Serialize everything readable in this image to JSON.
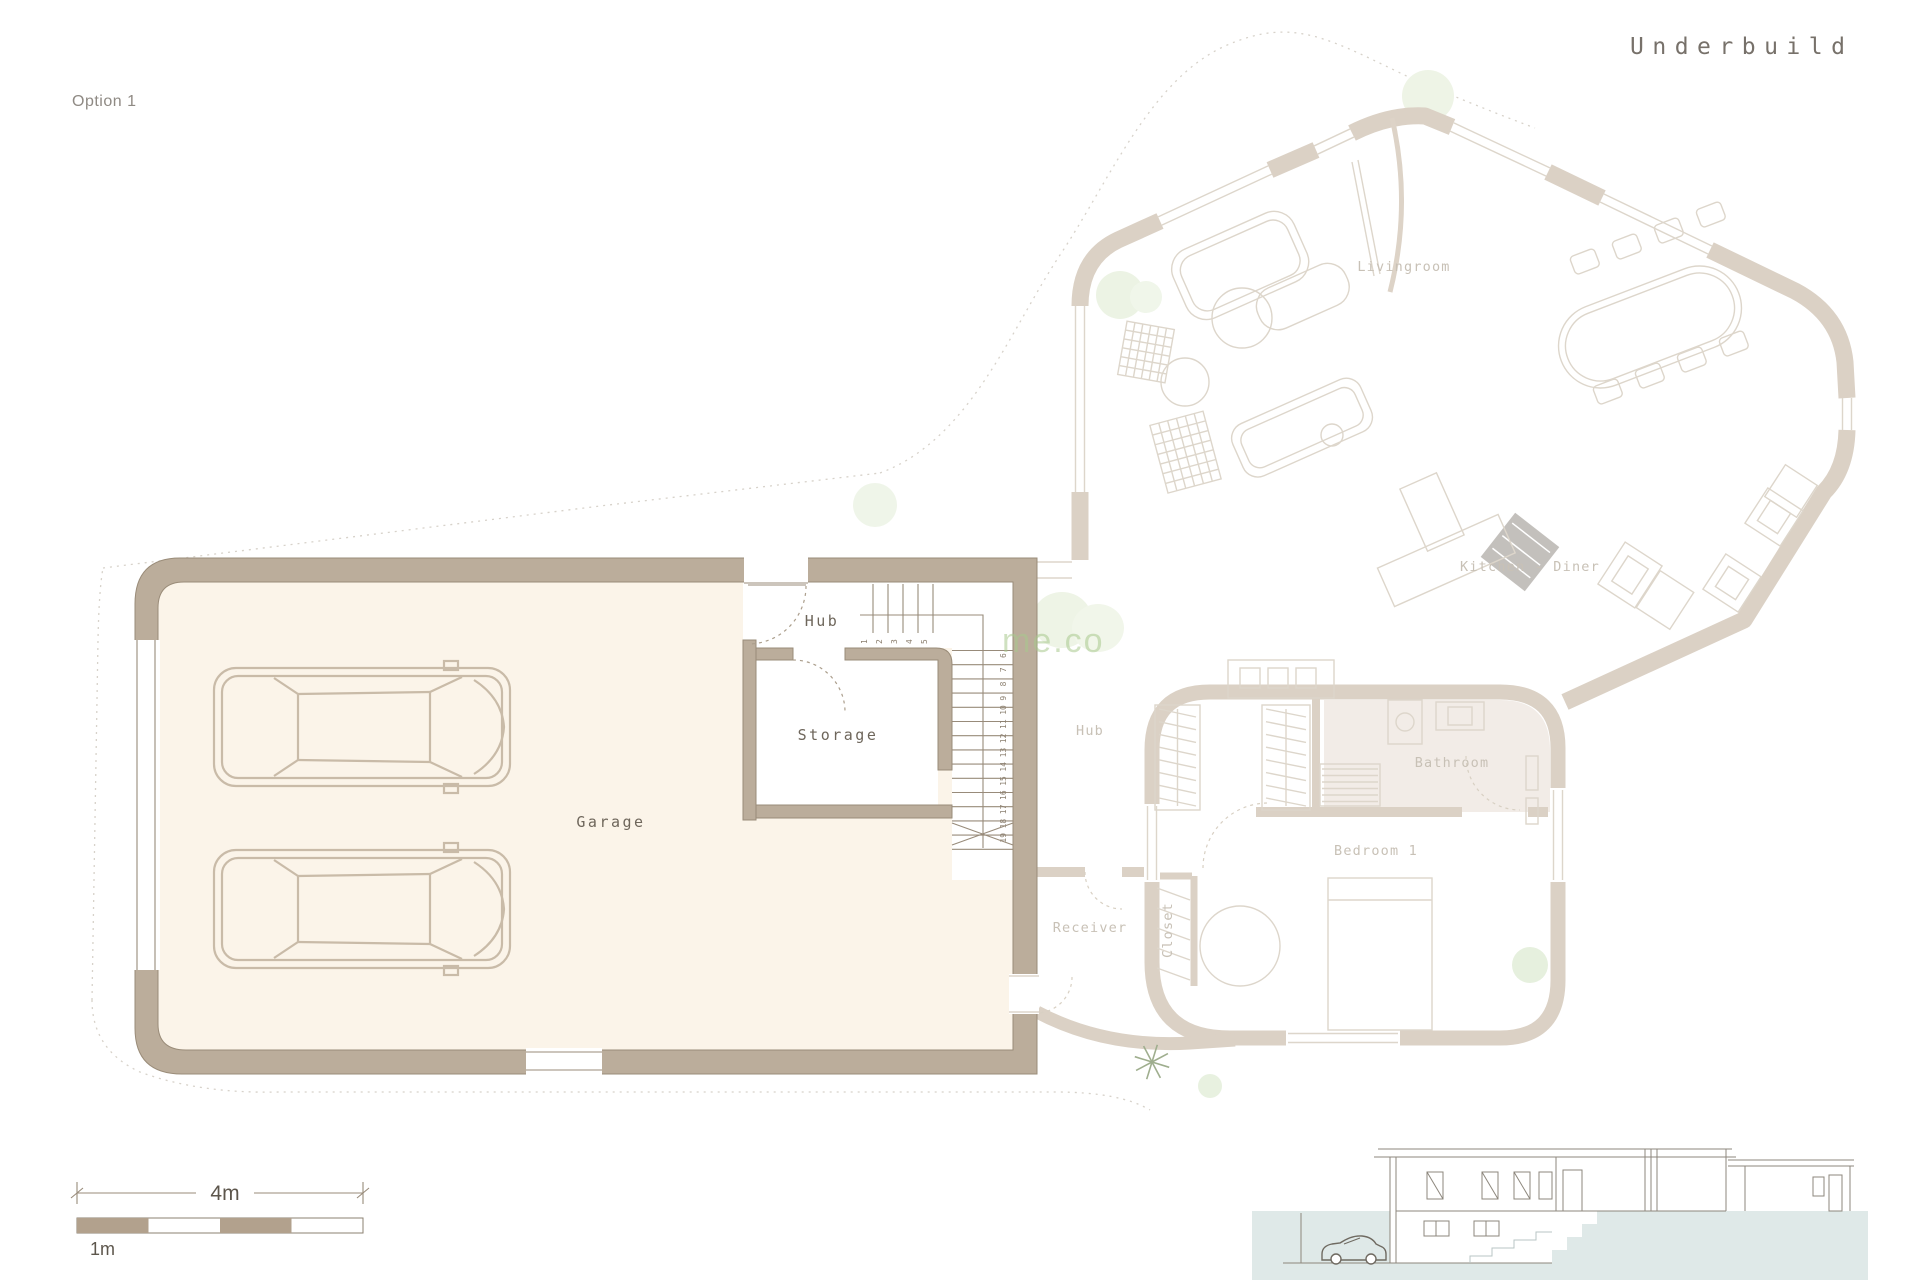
{
  "title": "Underbuild",
  "option_label": "Option 1",
  "watermark_text": "me.co",
  "rooms": {
    "garage": "Garage",
    "hub": "Hub",
    "storage": "Storage",
    "upper_hub": "Hub",
    "livingroom": "Livingroom",
    "kitchen_diner": "Kitchen - Diner",
    "bathroom": "Bathroom",
    "bedroom": "Bedroom 1",
    "receiver": "Receiver",
    "closet": "Closet"
  },
  "stairs": {
    "upper_steps": [
      "1",
      "2",
      "3",
      "4",
      "5"
    ],
    "lower_steps": [
      "6",
      "7",
      "8",
      "9",
      "10",
      "11",
      "12",
      "13",
      "14",
      "15",
      "16",
      "17",
      "18",
      "19"
    ]
  },
  "scale_bar": {
    "total": "4m",
    "unit": "1m"
  },
  "colors": {
    "crisp_wall": "#bbad9b",
    "garage_floor": "#fbf4e9",
    "faded_wall": "#dbd1c5",
    "bathroom_fill": "#f2ece7",
    "terrain_fill": "#dfe9e8",
    "plant_green": "#ecf3e4",
    "label_dark": "#6e665b",
    "label_faded": "#c8c1b6"
  }
}
